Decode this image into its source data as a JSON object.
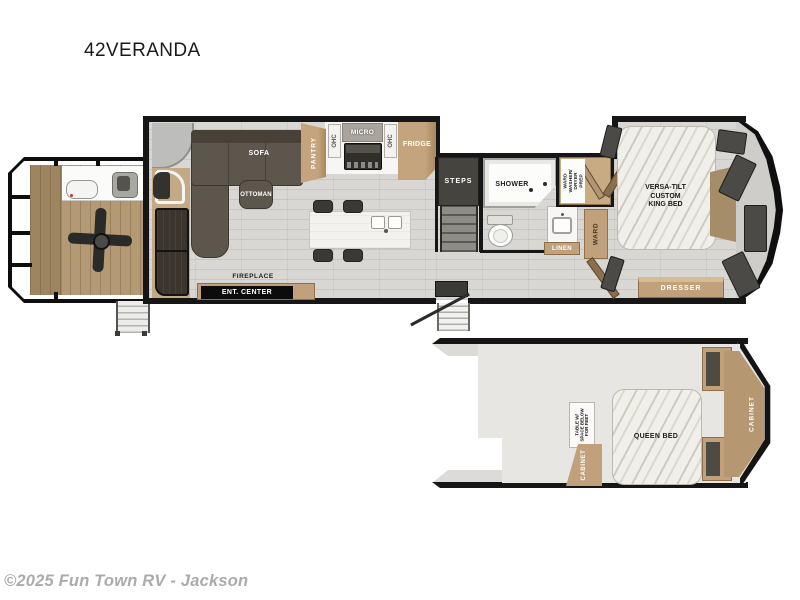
{
  "title": "42VERANDA",
  "footer": {
    "copyright": "©2025 Fun Town RV - Jackson"
  },
  "colors": {
    "wall": "#161616",
    "cabinet_tan": "#c1a17b",
    "sofa_dark": "#5c564c",
    "floor_wood": "#d9d7d3",
    "deck_wood": "#b39a74",
    "window_dark": "#4b4a47"
  },
  "main_floor": {
    "living": {
      "sofa": "SOFA",
      "ottoman": "OTTOMAN",
      "fireplace": "FIREPLACE",
      "ent_center": "ENT. CENTER"
    },
    "kitchen": {
      "pantry": "PANTRY",
      "ohc_left": "OHC",
      "micro": "MICRO",
      "ohc_right": "OHC",
      "fridge": "FRIDGE"
    },
    "stairs": {
      "steps": "STEPS"
    },
    "bath": {
      "shower": "SHOWER",
      "linen": "LINEN",
      "ward_wd": [
        "WARD",
        "WASHER/",
        "DRYER",
        "PREP"
      ],
      "ward": "WARD"
    },
    "bedroom": {
      "bed": [
        "VERSA-TILT",
        "CUSTOM",
        "KING BED"
      ],
      "dresser": "DRESSER"
    }
  },
  "loft": {
    "table": [
      "TABLE W/",
      "SPACE BELOW",
      "FOR FEET"
    ],
    "cabinet_left": "CABINET",
    "queen_bed": "QUEEN BED",
    "shelves_top": "SHELVES",
    "shelves_bottom": "SHELVES",
    "cabinet_right": "CABINET"
  }
}
